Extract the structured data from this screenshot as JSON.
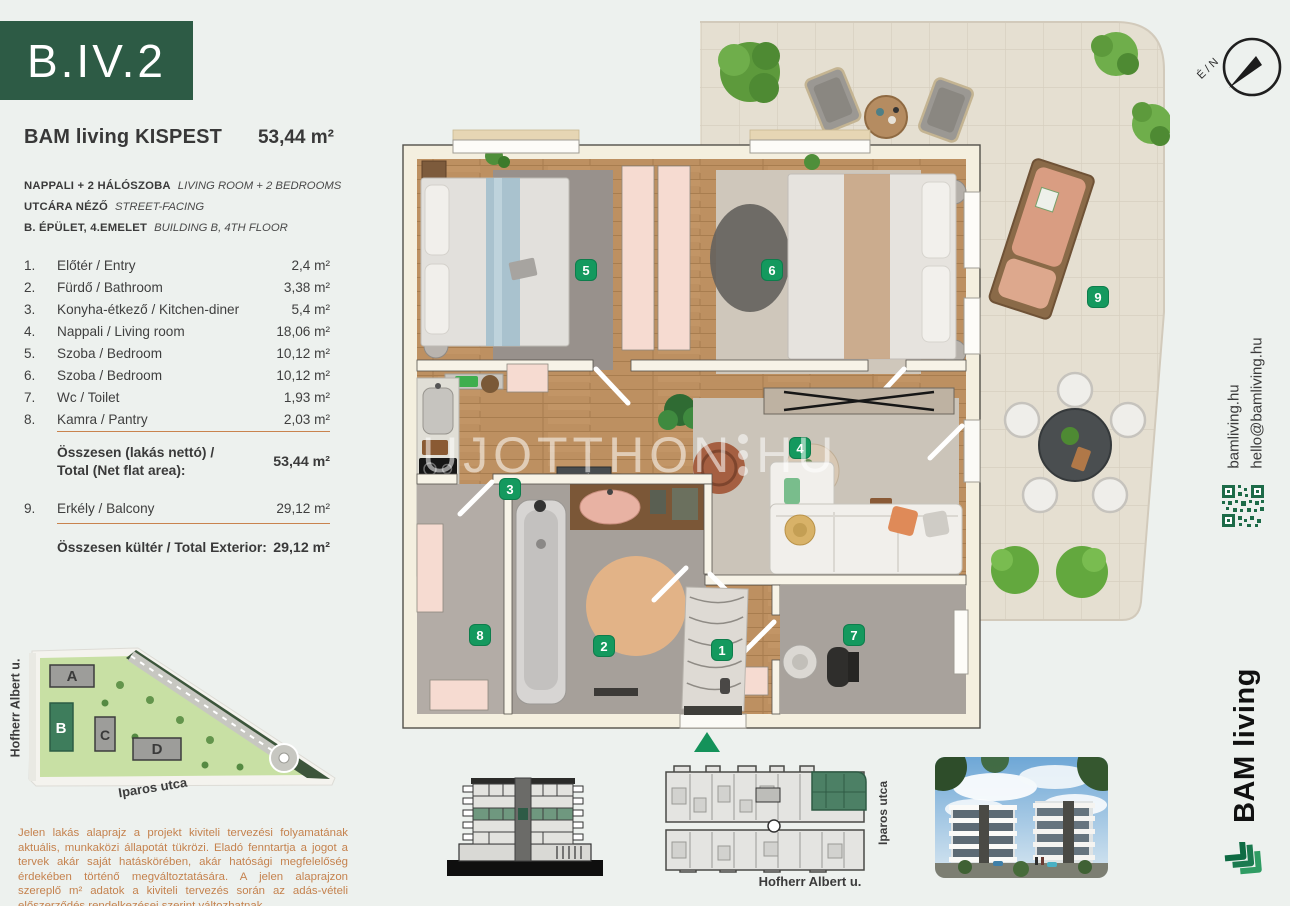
{
  "unit": {
    "code": "B.IV.2"
  },
  "header": {
    "project": "BAM living KISPEST",
    "total_area": "53,44 m²"
  },
  "specs": [
    {
      "hu": "NAPPALI + 2 HÁLÓSZOBA",
      "en": "LIVING ROOM + 2 BEDROOMS"
    },
    {
      "hu": "UTCÁRA NÉZŐ",
      "en": "STREET-FACING"
    },
    {
      "hu": "B. ÉPÜLET, 4.EMELET",
      "en": "BUILDING B, 4TH FLOOR"
    }
  ],
  "rooms": [
    {
      "num": "1.",
      "name": "Előtér / Entry",
      "area": "2,4 m²"
    },
    {
      "num": "2.",
      "name": "Fürdő / Bathroom",
      "area": "3,38 m²"
    },
    {
      "num": "3.",
      "name": "Konyha-étkező / Kitchen-diner",
      "area": "5,4 m²"
    },
    {
      "num": "4.",
      "name": "Nappali / Living room",
      "area": "18,06 m²"
    },
    {
      "num": "5.",
      "name": "Szoba / Bedroom",
      "area": "10,12 m²"
    },
    {
      "num": "6.",
      "name": "Szoba / Bedroom",
      "area": "10,12 m²"
    },
    {
      "num": "7.",
      "name": "Wc / Toilet",
      "area": "1,93 m²"
    },
    {
      "num": "8.",
      "name": "Kamra / Pantry",
      "area": "2,03 m²"
    }
  ],
  "totals": {
    "net_label_hu": "Összesen (lakás nettó) /",
    "net_label_en": "Total (Net flat area):",
    "net_value": "53,44 m²",
    "balcony": {
      "num": "9.",
      "name": "Erkély / Balcony",
      "area": "29,12 m²"
    },
    "exterior_label": "Összesen kültér / Total Exterior:",
    "exterior_value": "29,12 m²"
  },
  "site_map": {
    "street_left": "Hofherr Albert u.",
    "street_bottom": "Iparos utca",
    "buildings": [
      "A",
      "B",
      "C",
      "D"
    ]
  },
  "disclaimer": "Jelen lakás alaprajz a projekt kiviteli tervezési folyamatának aktuális, munkaközi állapotát tükrözi. Eladó fenntartja a jogot a tervek akár saját hatáskörében, akár hatósági megfelelőség érdekében történő megváltoztatására. A jelen alaprajzon szereplő m² adatok a kiviteli tervezés során az adás-vételi előszerződés rendelkezései szerint változhatnak.",
  "plan": {
    "badges": [
      "1",
      "2",
      "3",
      "4",
      "5",
      "6",
      "7",
      "8",
      "9"
    ],
    "watermark_left": "UJOTTHON",
    "watermark_right": "HU",
    "compass_label": "É / N"
  },
  "footer": {
    "street_bottom": "Hofherr Albert u.",
    "street_right": "Iparos utca"
  },
  "sidebar": {
    "website": "bamliving.hu",
    "email": "hello@bamliving.hu",
    "brand": "BAM living"
  },
  "colors": {
    "brand_green": "#2d5b45",
    "badge_green": "#14995e",
    "accent_orange": "#c9834e",
    "highlight_green": "#4c8065"
  }
}
